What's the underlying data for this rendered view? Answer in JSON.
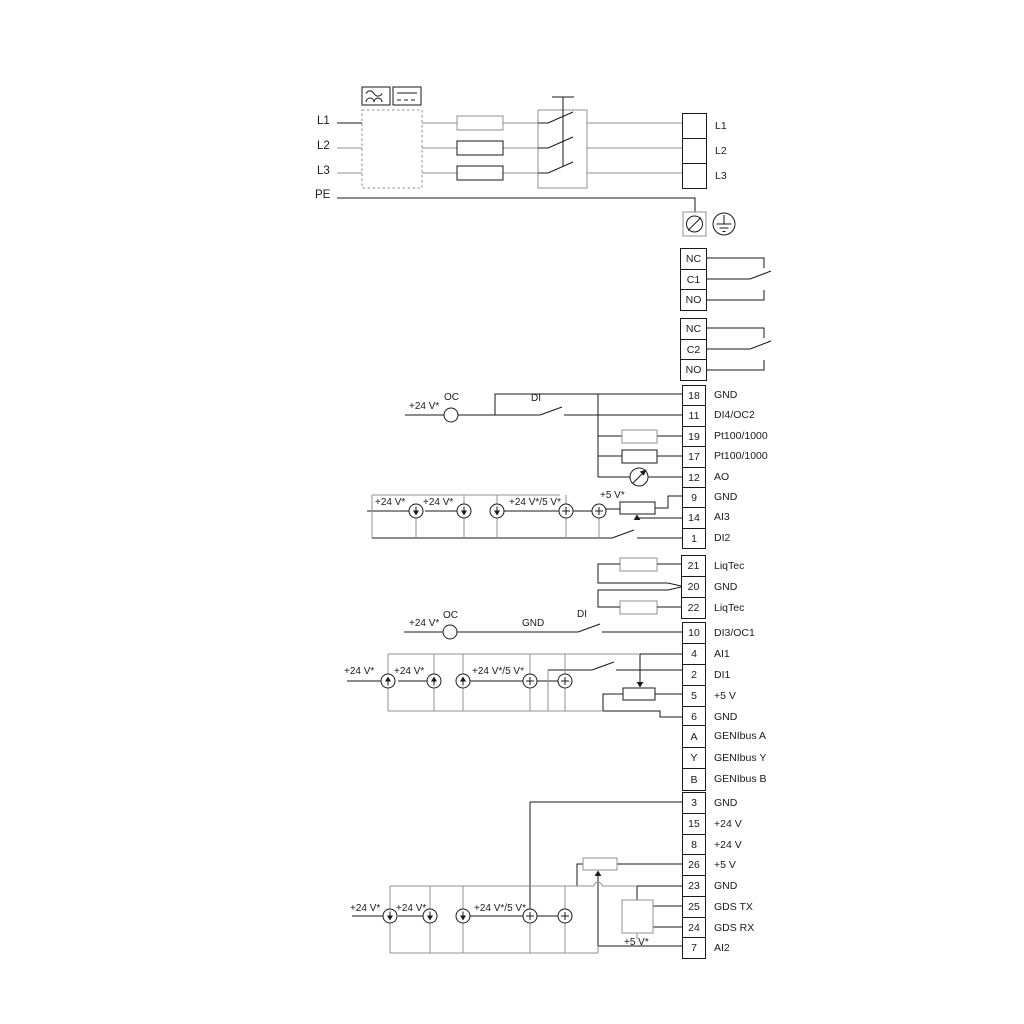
{
  "diagram": {
    "type": "pump-drive-wiring-diagram",
    "colors": {
      "wire_black": "#1a1a1a",
      "wire_gray": "#909090",
      "background": "#ffffff"
    },
    "strips": {
      "power": {
        "rows": [
          {
            "num": "",
            "label": "L1"
          },
          {
            "num": "",
            "label": "L2"
          },
          {
            "num": "",
            "label": "L3"
          }
        ]
      },
      "relay1": {
        "rows": [
          {
            "num": "NC",
            "label": ""
          },
          {
            "num": "C1",
            "label": ""
          },
          {
            "num": "NO",
            "label": ""
          }
        ]
      },
      "relay2": {
        "rows": [
          {
            "num": "NC",
            "label": ""
          },
          {
            "num": "C2",
            "label": ""
          },
          {
            "num": "NO",
            "label": ""
          }
        ]
      },
      "io_top": {
        "rows": [
          {
            "num": "18",
            "label": "GND"
          },
          {
            "num": "11",
            "label": "DI4/OC2"
          },
          {
            "num": "19",
            "label": "Pt100/1000"
          },
          {
            "num": "17",
            "label": "Pt100/1000"
          },
          {
            "num": "12",
            "label": "AO"
          },
          {
            "num": "9",
            "label": "GND"
          },
          {
            "num": "14",
            "label": "AI3"
          },
          {
            "num": "1",
            "label": "DI2"
          }
        ]
      },
      "liqtec": {
        "rows": [
          {
            "num": "21",
            "label": "LiqTec"
          },
          {
            "num": "20",
            "label": "GND"
          },
          {
            "num": "22",
            "label": "LiqTec"
          }
        ]
      },
      "io_mid": {
        "rows": [
          {
            "num": "10",
            "label": "DI3/OC1"
          },
          {
            "num": "4",
            "label": "AI1"
          },
          {
            "num": "2",
            "label": "DI1"
          },
          {
            "num": "5",
            "label": "+5 V"
          },
          {
            "num": "6",
            "label": "GND"
          }
        ]
      },
      "genibus": {
        "rows": [
          {
            "num": "A",
            "label": "GENIbus A"
          },
          {
            "num": "Y",
            "label": "GENIbus Y"
          },
          {
            "num": "B",
            "label": "GENIbus B"
          }
        ]
      },
      "io_bottom": {
        "rows": [
          {
            "num": "3",
            "label": "GND"
          },
          {
            "num": "15",
            "label": "+24 V"
          },
          {
            "num": "8",
            "label": "+24 V"
          },
          {
            "num": "26",
            "label": "+5 V"
          },
          {
            "num": "23",
            "label": "GND"
          },
          {
            "num": "25",
            "label": "GDS TX"
          },
          {
            "num": "24",
            "label": "GDS RX"
          },
          {
            "num": "7",
            "label": "AI2"
          }
        ]
      }
    },
    "annotations": [
      {
        "id": "in-l1",
        "text": "L1"
      },
      {
        "id": "in-l2",
        "text": "L2"
      },
      {
        "id": "in-l3",
        "text": "L3"
      },
      {
        "id": "in-pe",
        "text": "PE"
      },
      {
        "id": "oc2-24v",
        "text": "+24 V*"
      },
      {
        "id": "oc2-oc",
        "text": "OC"
      },
      {
        "id": "di4-di",
        "text": "DI"
      },
      {
        "id": "ai3-24v-1",
        "text": "+24 V*"
      },
      {
        "id": "ai3-24v-2",
        "text": "+24 V*"
      },
      {
        "id": "ai3-24v5",
        "text": "+24 V*/5 V*"
      },
      {
        "id": "ai3-5v",
        "text": "+5 V*"
      },
      {
        "id": "oc1-24v",
        "text": "+24 V*"
      },
      {
        "id": "oc1-oc",
        "text": "OC"
      },
      {
        "id": "oc1-gnd",
        "text": "GND"
      },
      {
        "id": "oc1-di",
        "text": "DI"
      },
      {
        "id": "ai1-24v-1",
        "text": "+24 V*"
      },
      {
        "id": "ai1-24v-2",
        "text": "+24 V*"
      },
      {
        "id": "ai1-24v5",
        "text": "+24 V*/5 V*"
      },
      {
        "id": "ai2-24v-1",
        "text": "+24 V*"
      },
      {
        "id": "ai2-24v-2",
        "text": "+24 V*"
      },
      {
        "id": "ai2-24v5",
        "text": "+24 V*/5 V*"
      },
      {
        "id": "ai2-5v",
        "text": "+5 V*"
      }
    ]
  }
}
